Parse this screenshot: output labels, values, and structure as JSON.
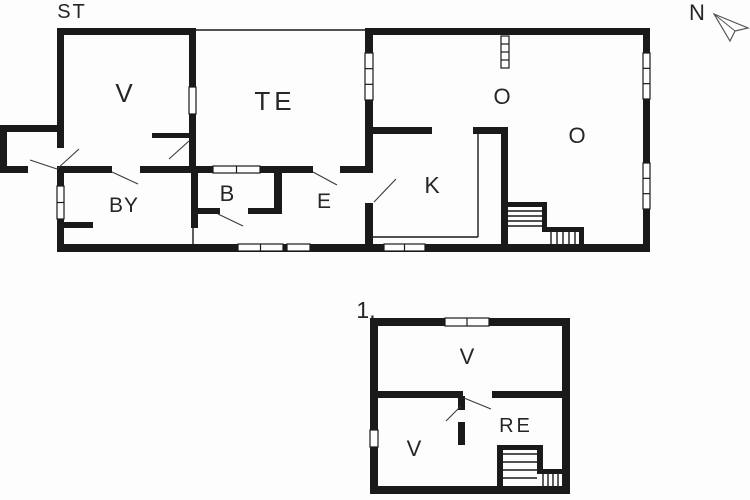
{
  "colors": {
    "wall": "#1a1a1a",
    "text": "#262626",
    "background": "#fdfdfd",
    "swing": "#3a3a3a"
  },
  "labels": [
    {
      "id": "st",
      "text": "ST",
      "x": 72,
      "y": 18,
      "size": 20,
      "ls": 2
    },
    {
      "id": "room-v-ground",
      "text": "V",
      "x": 124,
      "y": 102,
      "size": 26,
      "ls": 0
    },
    {
      "id": "room-te",
      "text": "TE",
      "x": 275,
      "y": 110,
      "size": 26,
      "ls": 4
    },
    {
      "id": "room-o-upper",
      "text": "O",
      "x": 502,
      "y": 104,
      "size": 22,
      "ls": 0
    },
    {
      "id": "room-o-right",
      "text": "O",
      "x": 577,
      "y": 143,
      "size": 22,
      "ls": 0
    },
    {
      "id": "room-by",
      "text": "BY",
      "x": 124,
      "y": 212,
      "size": 21,
      "ls": 1
    },
    {
      "id": "room-b",
      "text": "B",
      "x": 227,
      "y": 201,
      "size": 22,
      "ls": 0
    },
    {
      "id": "room-e",
      "text": "E",
      "x": 324,
      "y": 208,
      "size": 21,
      "ls": 0
    },
    {
      "id": "room-k",
      "text": "K",
      "x": 432,
      "y": 193,
      "size": 23,
      "ls": 0
    },
    {
      "id": "floor-1",
      "text": "1.",
      "x": 366,
      "y": 318,
      "size": 23,
      "ls": 0
    },
    {
      "id": "room-v-first-upper",
      "text": "V",
      "x": 467,
      "y": 364,
      "size": 22,
      "ls": 0
    },
    {
      "id": "room-v-first-lower",
      "text": "V",
      "x": 414,
      "y": 456,
      "size": 22,
      "ls": 0
    },
    {
      "id": "room-re",
      "text": "RE",
      "x": 516,
      "y": 432,
      "size": 20,
      "ls": 3
    }
  ],
  "compass": {
    "label": "N",
    "x": 697,
    "y": 20,
    "size": 22,
    "arrow_points": "714,14 748,28 735,31 730,41",
    "arrow_inner": [
      714,
      14,
      735,
      31
    ]
  },
  "geometry": {
    "walls": [
      [
        57,
        28,
        139,
        7
      ],
      [
        57,
        28,
        7,
        120
      ],
      [
        0,
        125,
        7,
        48
      ],
      [
        5,
        125,
        52,
        7
      ],
      [
        0,
        166,
        28,
        7
      ],
      [
        57,
        166,
        7,
        20
      ],
      [
        57,
        218,
        7,
        28
      ],
      [
        57,
        244,
        593,
        8
      ],
      [
        57,
        166,
        55,
        7
      ],
      [
        140,
        166,
        58,
        7
      ],
      [
        189,
        28,
        7,
        60
      ],
      [
        189,
        113,
        7,
        60
      ],
      [
        152,
        133,
        37,
        5
      ],
      [
        191,
        166,
        7,
        62
      ],
      [
        198,
        166,
        15,
        7
      ],
      [
        260,
        166,
        16,
        7
      ],
      [
        274,
        166,
        8,
        48
      ],
      [
        198,
        208,
        22,
        6
      ],
      [
        248,
        208,
        28,
        6
      ],
      [
        282,
        166,
        31,
        7
      ],
      [
        340,
        166,
        26,
        7
      ],
      [
        365,
        28,
        8,
        25
      ],
      [
        365,
        100,
        8,
        73
      ],
      [
        365,
        203,
        8,
        42
      ],
      [
        365,
        28,
        285,
        7
      ],
      [
        643,
        28,
        7,
        25
      ],
      [
        643,
        99,
        7,
        64
      ],
      [
        643,
        209,
        7,
        43
      ],
      [
        373,
        127,
        59,
        7
      ],
      [
        473,
        127,
        35,
        7
      ],
      [
        501,
        127,
        7,
        118
      ],
      [
        508,
        202,
        39,
        5
      ],
      [
        542,
        202,
        5,
        30
      ],
      [
        542,
        227,
        42,
        5
      ],
      [
        579,
        227,
        5,
        18
      ],
      [
        62,
        222,
        31,
        6
      ],
      [
        370,
        318,
        75,
        8
      ],
      [
        489,
        318,
        81,
        8
      ],
      [
        370,
        318,
        8,
        112
      ],
      [
        370,
        447,
        8,
        47
      ],
      [
        562,
        318,
        8,
        176
      ],
      [
        370,
        486,
        200,
        8
      ],
      [
        370,
        391,
        93,
        7
      ],
      [
        492,
        391,
        78,
        7
      ],
      [
        458,
        396,
        7,
        14
      ],
      [
        458,
        422,
        7,
        23
      ],
      [
        497,
        445,
        6,
        41
      ],
      [
        497,
        445,
        46,
        5
      ],
      [
        537,
        445,
        6,
        27
      ],
      [
        537,
        469,
        25,
        5
      ]
    ],
    "thin_lines": [
      [
        196,
        30,
        366,
        30
      ],
      [
        478,
        134,
        478,
        237
      ],
      [
        373,
        237,
        478,
        237
      ],
      [
        193,
        228,
        193,
        244
      ],
      [
        508,
        211,
        542,
        211
      ],
      [
        508,
        216,
        542,
        216
      ],
      [
        508,
        221,
        542,
        221
      ],
      [
        508,
        226,
        542,
        226
      ],
      [
        551,
        232,
        551,
        244
      ],
      [
        557,
        232,
        557,
        244
      ],
      [
        563,
        232,
        563,
        244
      ],
      [
        569,
        232,
        569,
        244
      ],
      [
        575,
        232,
        575,
        244
      ],
      [
        503,
        454,
        537,
        454
      ],
      [
        503,
        462,
        537,
        462
      ],
      [
        503,
        470,
        537,
        470
      ],
      [
        503,
        478,
        537,
        478
      ],
      [
        543,
        474,
        543,
        486
      ],
      [
        548,
        474,
        548,
        486
      ],
      [
        553,
        474,
        553,
        486
      ],
      [
        558,
        474,
        558,
        486
      ]
    ],
    "windows": [
      {
        "name": "window",
        "x": 189,
        "y": 87,
        "w": 7,
        "h": 27,
        "panes": 1
      },
      {
        "name": "window",
        "x": 57,
        "y": 186,
        "w": 7,
        "h": 33,
        "panes": 2
      },
      {
        "name": "window",
        "x": 365,
        "y": 53,
        "w": 8,
        "h": 47,
        "panes": 3
      },
      {
        "name": "window",
        "x": 643,
        "y": 53,
        "w": 7,
        "h": 46,
        "panes": 3
      },
      {
        "name": "window",
        "x": 643,
        "y": 163,
        "w": 7,
        "h": 46,
        "panes": 3
      },
      {
        "name": "window",
        "x": 238,
        "y": 244,
        "w": 45,
        "h": 7,
        "panes": 2
      },
      {
        "name": "window",
        "x": 287,
        "y": 244,
        "w": 23,
        "h": 7,
        "panes": 1
      },
      {
        "name": "window",
        "x": 384,
        "y": 244,
        "w": 41,
        "h": 7,
        "panes": 2
      },
      {
        "name": "window",
        "x": 213,
        "y": 166,
        "w": 47,
        "h": 7,
        "panes": 2
      },
      {
        "name": "chimney",
        "x": 501,
        "y": 36,
        "w": 8,
        "h": 32,
        "panes": 4
      },
      {
        "name": "window",
        "x": 445,
        "y": 318,
        "w": 44,
        "h": 8,
        "panes": 2
      },
      {
        "name": "window",
        "x": 370,
        "y": 430,
        "w": 8,
        "h": 17,
        "panes": 1
      }
    ],
    "door_swings": [
      [
        57,
        169,
        30,
        160
      ],
      [
        57,
        169,
        79,
        149
      ],
      [
        112,
        172,
        138,
        184
      ],
      [
        189,
        141,
        169,
        159
      ],
      [
        218,
        214,
        243,
        226
      ],
      [
        313,
        172,
        337,
        185
      ],
      [
        374,
        202,
        396,
        179
      ],
      [
        464,
        398,
        491,
        409
      ],
      [
        461,
        406,
        446,
        421
      ]
    ]
  }
}
